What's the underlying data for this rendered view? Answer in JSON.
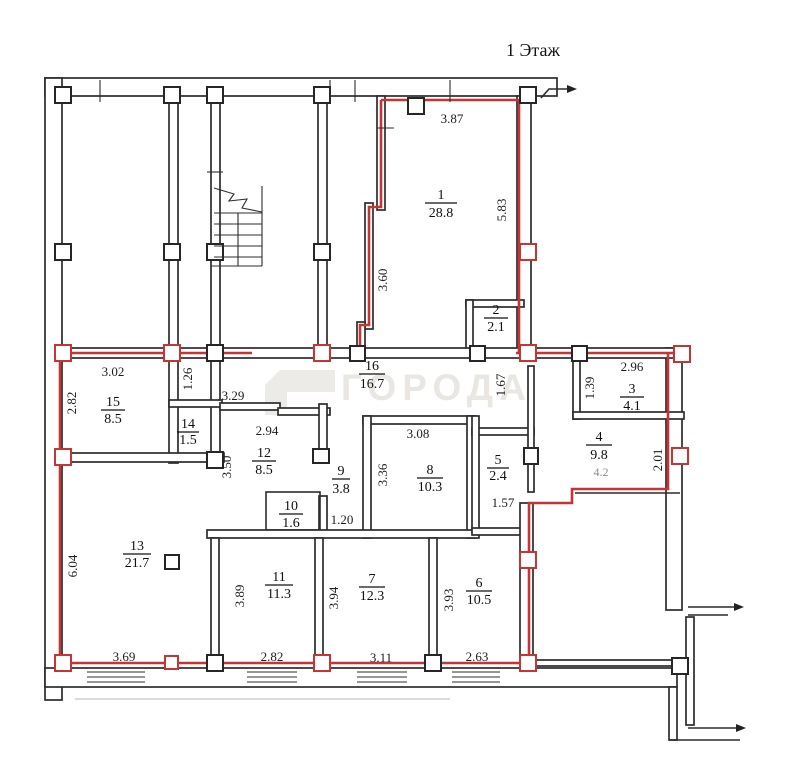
{
  "title": "1 Этаж",
  "watermark": {
    "text": "ГОРОДА"
  },
  "colors": {
    "red_outline": "#c63434",
    "wall": "#2c2c2c",
    "watermark_gray": "#eae7e2"
  },
  "rooms": [
    {
      "num": "1",
      "area": "28.8"
    },
    {
      "num": "2",
      "area": "2.1"
    },
    {
      "num": "3",
      "area": "4.1"
    },
    {
      "num": "4",
      "area": "9.8"
    },
    {
      "num": "5",
      "area": "2.4"
    },
    {
      "num": "6",
      "area": "10.5"
    },
    {
      "num": "7",
      "area": "12.3"
    },
    {
      "num": "8",
      "area": "10.3"
    },
    {
      "num": "9",
      "area": "3.8"
    },
    {
      "num": "10",
      "area": "1.6"
    },
    {
      "num": "11",
      "area": "11.3"
    },
    {
      "num": "12",
      "area": "8.5"
    },
    {
      "num": "13",
      "area": "21.7"
    },
    {
      "num": "14",
      "area": "1.5"
    },
    {
      "num": "15",
      "area": "8.5"
    },
    {
      "num": "16",
      "area": "16.7"
    }
  ],
  "dims": [
    {
      "value": "3.87"
    },
    {
      "value": "5.83"
    },
    {
      "value": "3.60"
    },
    {
      "value": "2.96"
    },
    {
      "value": "1.39"
    },
    {
      "value": "2.01"
    },
    {
      "value": "1.67"
    },
    {
      "value": "3.02"
    },
    {
      "value": "2.82"
    },
    {
      "value": "1.26"
    },
    {
      "value": "3.29"
    },
    {
      "value": "2.94"
    },
    {
      "value": "3.50"
    },
    {
      "value": "3.08"
    },
    {
      "value": "3.36"
    },
    {
      "value": "1.57"
    },
    {
      "value": "1.20"
    },
    {
      "value": "6.04"
    },
    {
      "value": "3.89"
    },
    {
      "value": "3.94"
    },
    {
      "value": "3.93"
    },
    {
      "value": "3.69"
    },
    {
      "value": "2.82"
    },
    {
      "value": "3.11"
    },
    {
      "value": "2.63"
    },
    {
      "value": "4.2"
    }
  ]
}
